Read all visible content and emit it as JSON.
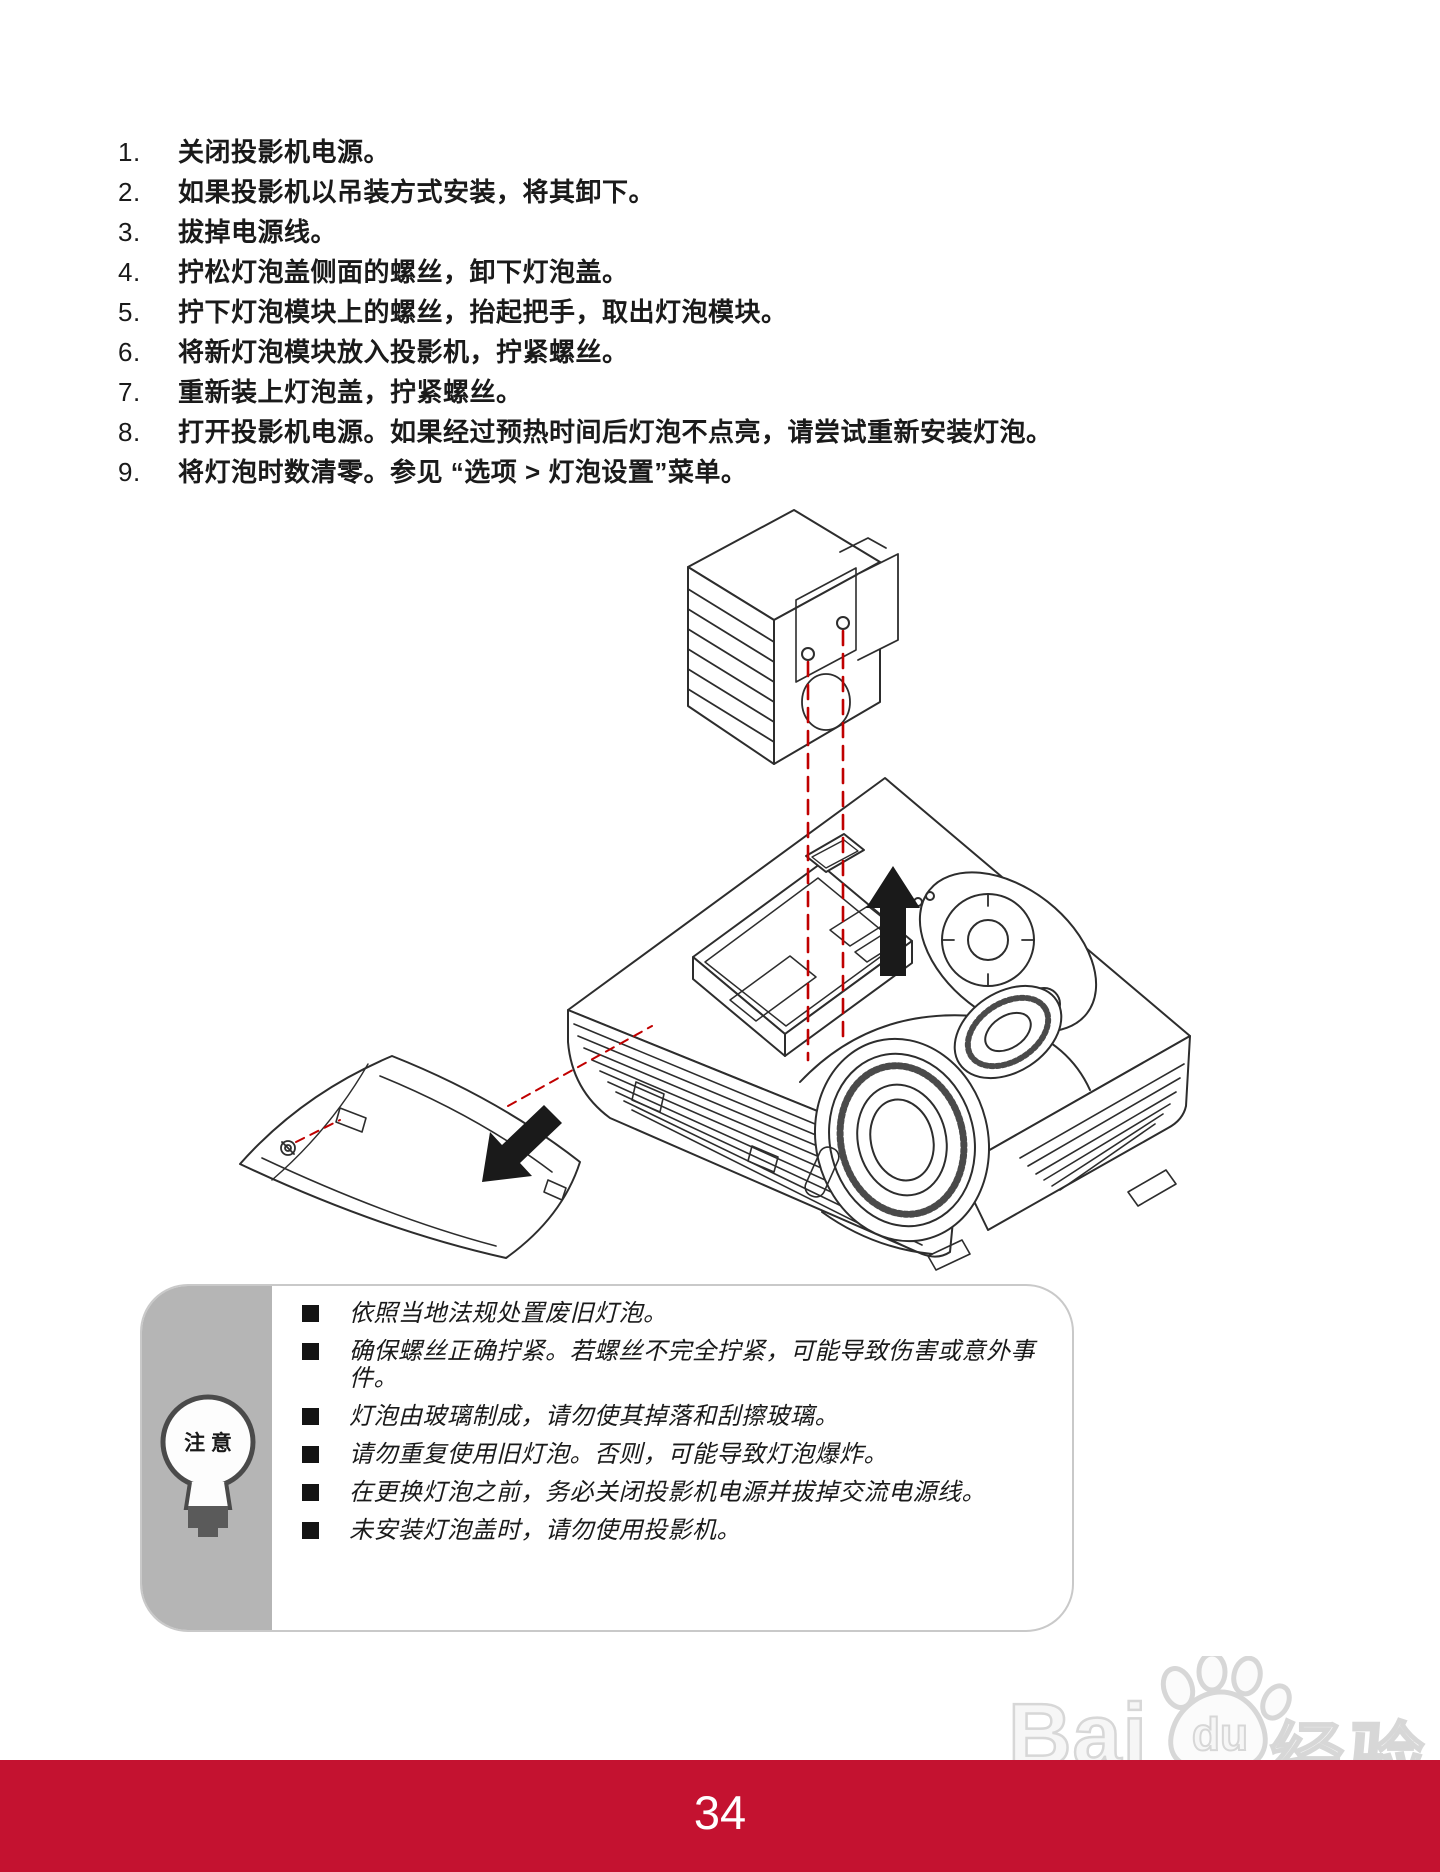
{
  "steps": {
    "items": [
      {
        "num": "1.",
        "text": "关闭投影机电源。"
      },
      {
        "num": "2.",
        "text": "如果投影机以吊装方式安装，将其卸下。"
      },
      {
        "num": "3.",
        "text": "拔掉电源线。"
      },
      {
        "num": "4.",
        "text": "拧松灯泡盖侧面的螺丝，卸下灯泡盖。"
      },
      {
        "num": "5.",
        "text": "拧下灯泡模块上的螺丝，抬起把手，取出灯泡模块。"
      },
      {
        "num": "6.",
        "text": "将新灯泡模块放入投影机，拧紧螺丝。"
      },
      {
        "num": "7.",
        "text": "重新装上灯泡盖，拧紧螺丝。"
      },
      {
        "num": "8.",
        "text": "打开投影机电源。如果经过预热时间后灯泡不点亮，请尝试重新安装灯泡。"
      },
      {
        "num": "9.",
        "prefix": "将灯泡时数清零。参见 “",
        "bold": "选项 > 灯泡设置",
        "suffix": "”菜单。"
      }
    ]
  },
  "note": {
    "label": "注 意",
    "bullets": [
      "依照当地法规处置废旧灯泡。",
      "确保螺丝正确拧紧。若螺丝不完全拧紧，可能导致伤害或意外事件。",
      "灯泡由玻璃制成，请勿使其掉落和刮擦玻璃。",
      "请勿重复使用旧灯泡。否则，可能导致灯泡爆炸。",
      "在更换灯泡之前，务必关闭投影机电源并拔掉交流电源线。",
      "未安装灯泡盖时，请勿使用投影机。"
    ]
  },
  "watermark": {
    "brand": "Bai",
    "paw_text": "du",
    "brand_cn": "经验",
    "url": "jingyan.baidu.com"
  },
  "footer": {
    "page_number": "34"
  },
  "colors": {
    "footer_bar": "#c41230",
    "guide_dash_red": "#c00000",
    "note_sidebar_grey": "#b5b5b5",
    "line_art": "#2d2d2d"
  }
}
